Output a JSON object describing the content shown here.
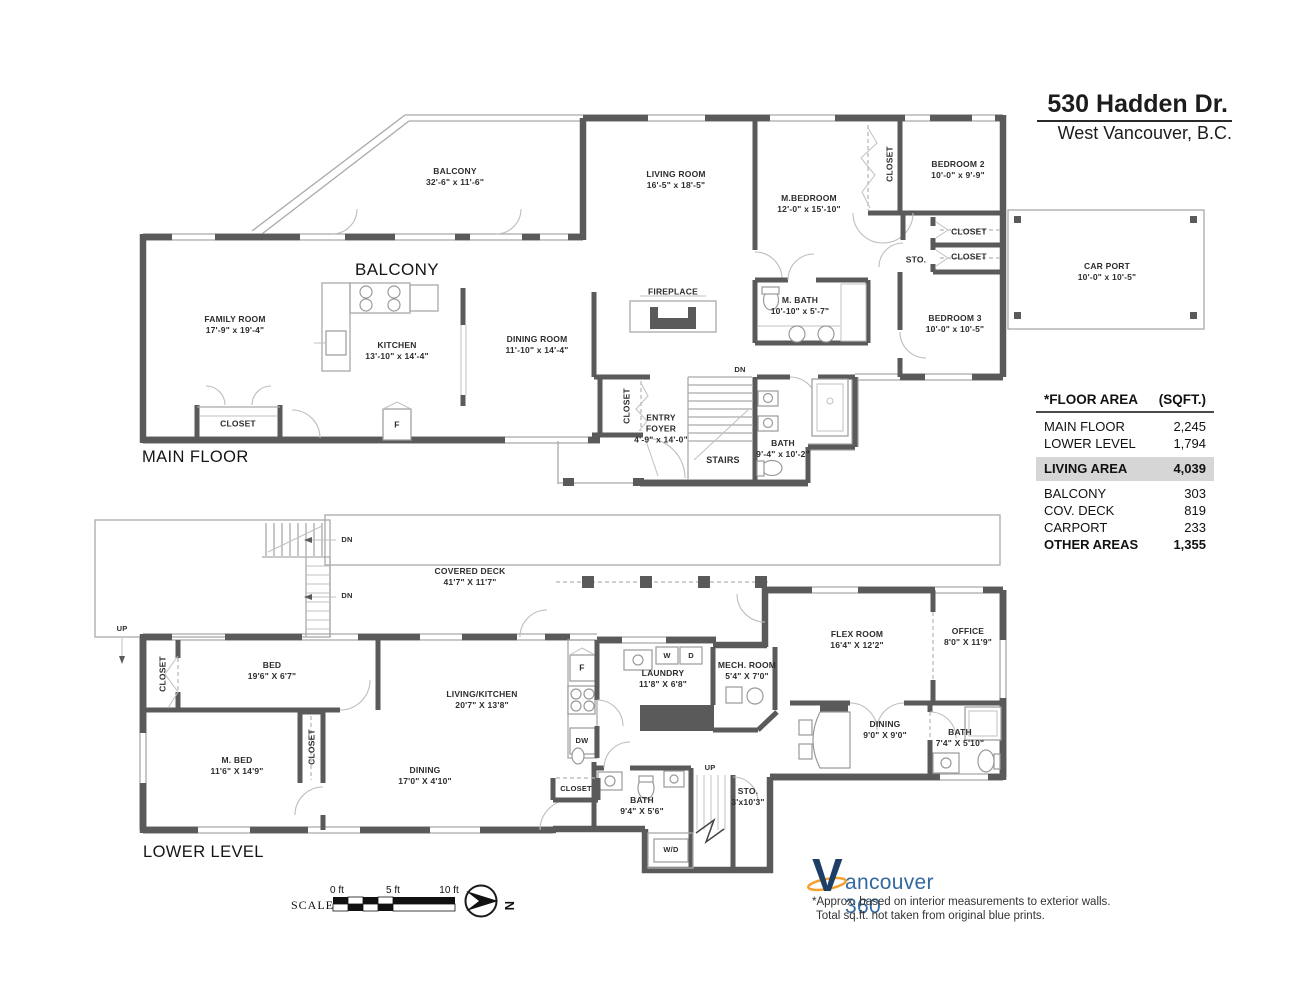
{
  "title": {
    "address": "530 Hadden Dr.",
    "city": "West Vancouver, B.C."
  },
  "area_table": {
    "header_label": "*FLOOR AREA",
    "header_unit": "(SQFT.)",
    "rows": [
      {
        "label": "MAIN FLOOR",
        "value": "2,245"
      },
      {
        "label": "LOWER LEVEL",
        "value": "1,794"
      }
    ],
    "living": {
      "label": "LIVING AREA",
      "value": "4,039"
    },
    "other_rows": [
      {
        "label": "BALCONY",
        "value": "303"
      },
      {
        "label": "COV. DECK",
        "value": "819"
      },
      {
        "label": "CARPORT",
        "value": "233"
      }
    ],
    "other_total": {
      "label": "OTHER AREAS",
      "value": "1,355"
    }
  },
  "main_floor": {
    "floor_label": "MAIN FLOOR",
    "balcony_caption": "BALCONY",
    "rooms": [
      {
        "name": "BALCONY",
        "dims": "32'-6\" x 11'-6\""
      },
      {
        "name": "LIVING ROOM",
        "dims": "16'-5\" x 18'-5\""
      },
      {
        "name": "M.BEDROOM",
        "dims": "12'-0\" x 15'-10\""
      },
      {
        "name": "BEDROOM 2",
        "dims": "10'-0\" x 9'-9\""
      },
      {
        "name": "BEDROOM 3",
        "dims": "10'-0\" x 10'-5\""
      },
      {
        "name": "CAR PORT",
        "dims": "10'-0\" x 10'-5\""
      },
      {
        "name": "FAMILY ROOM",
        "dims": "17'-9\" x 19'-4\""
      },
      {
        "name": "KITCHEN",
        "dims": "13'-10\" x 14'-4\""
      },
      {
        "name": "DINING ROOM",
        "dims": "11'-10\" x 14'-4\""
      },
      {
        "name": "M. BATH",
        "dims": "10'-10\" x 5'-7\""
      },
      {
        "name": "ENTRY FOYER",
        "dims": "4'-9\" x 14'-0\""
      },
      {
        "name": "BATH",
        "dims": "9'-4\" x 10'-2\""
      }
    ],
    "labels": {
      "closet": "CLOSET",
      "sto": "STO.",
      "fridge": "F",
      "fireplace": "FIREPLACE",
      "stairs": "STAIRS",
      "down": "DN"
    }
  },
  "lower_level": {
    "floor_label": "LOWER LEVEL",
    "rooms": [
      {
        "name": "COVERED DECK",
        "dims": "41'7\" X 11'7\""
      },
      {
        "name": "BED",
        "dims": "19'6\" X 6'7\""
      },
      {
        "name": "M. BED",
        "dims": "11'6\" X 14'9\""
      },
      {
        "name": "LIVING/KITCHEN",
        "dims": "20'7\" X 13'8\""
      },
      {
        "name": "DINING",
        "dims": "17'0\" X 4'10\""
      },
      {
        "name": "LAUNDRY",
        "dims": "11'8\" X 6'8\""
      },
      {
        "name": "MECH. ROOM",
        "dims": "5'4\" X 7'0\""
      },
      {
        "name": "FLEX ROOM",
        "dims": "16'4\" X 12'2\""
      },
      {
        "name": "OFFICE",
        "dims": "8'0\" X 11'9\""
      },
      {
        "name": "DINING",
        "dims": "9'0\" X 9'0\""
      },
      {
        "name": "BATH",
        "dims": "7'4\" X 5'10\""
      },
      {
        "name": "BATH",
        "dims": "9'4\" X 5'6\""
      },
      {
        "name": "STO.",
        "dims": "3'x10'3\""
      }
    ],
    "labels": {
      "closet": "CLOSET",
      "washer": "W",
      "dryer": "D",
      "washer_dryer": "W/D",
      "fridge": "F",
      "dishwasher": "DW",
      "up": "UP",
      "down": "DN"
    }
  },
  "footer": {
    "scale_label": "SCALE",
    "scale_ticks": [
      "0 ft",
      "5 ft",
      "10 ft"
    ],
    "north": "N",
    "logo_v": "V",
    "logo_rest": "ancouver 360",
    "disclaimer_line1": "*Approx. based on interior measurements to exterior walls.",
    "disclaimer_line2": "Total sq.ft. not taken from original blue prints."
  }
}
